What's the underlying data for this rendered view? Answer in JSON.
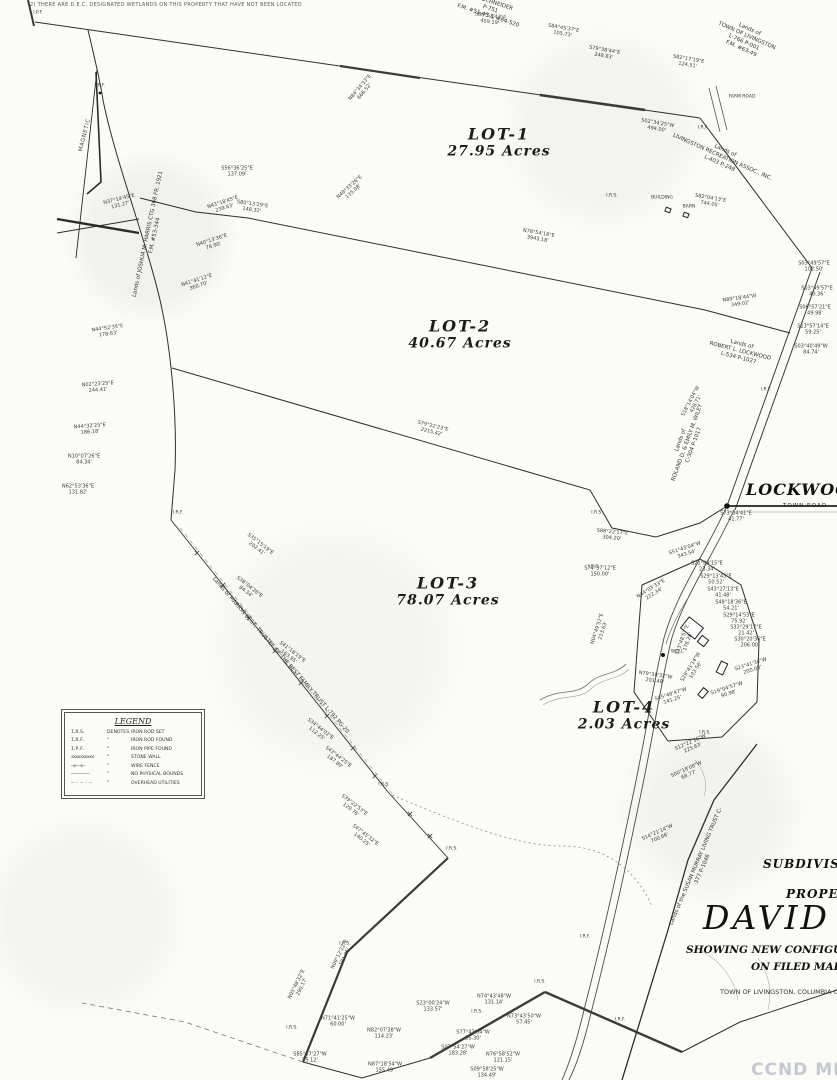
{
  "note": "2) THERE ARE D.E.C. DESIGNATED WETLANDS ON THIS PROPERTY THAT HAVE NOT BEEN LOCATED",
  "north_label": "MAGNETIC",
  "watermark": "CCND MLS",
  "roads": {
    "name": "LOCKWOOD R",
    "sub": "TOWN ROAD"
  },
  "title_block": {
    "line1": "SUBDIVISION",
    "line2": "PROPERTY",
    "name": "DAVID B",
    "line3": "SHOWING NEW CONFIGURAT",
    "line4": "ON FILED MAP #",
    "line5": "TOWN OF LIVINGSTON, COLUMBIA C"
  },
  "legend": {
    "title": "LEGEND",
    "rows": [
      {
        "sym": "I.R.S.",
        "mid": "DENOTES",
        "desc": "IRON ROD SET"
      },
      {
        "sym": "I.R.F.",
        "mid": "\"",
        "desc": "IRON ROD FOUND"
      },
      {
        "sym": "I.P.F.",
        "mid": "\"",
        "desc": "IRON PIPE FOUND"
      },
      {
        "sym": "xxxxxxxxxx",
        "mid": "\"",
        "desc": "STONE WALL"
      },
      {
        "sym": "—x——x—",
        "mid": "\"",
        "desc": "WIRE FENCE"
      },
      {
        "sym": "————————",
        "mid": "\"",
        "desc": "NO PHYSICAL BOUNDS"
      },
      {
        "sym": "— - — - —",
        "mid": "\"",
        "desc": "OVERHEAD UTILITIES"
      }
    ]
  },
  "lots": [
    {
      "name": "LOT-1",
      "acres": "27.95 Acres",
      "x": 499,
      "y": 142
    },
    {
      "name": "LOT-2",
      "acres": "40.67 Acres",
      "x": 460,
      "y": 334
    },
    {
      "name": "LOT-3",
      "acres": "78.07 Acres",
      "x": 448,
      "y": 591
    },
    {
      "name": "LOT-4",
      "acres": "2.03 Acres",
      "x": 624,
      "y": 715
    }
  ],
  "adjoiners": [
    {
      "text": "Y J. SCHNEIDER\nP-751\nF.M. #51-45 & #64-520",
      "x": 490,
      "y": 10,
      "r": 18,
      "size": 5.5
    },
    {
      "text": "Lands of\nTOWN OF LIVINGSTON\nL-766 P-001\nF.M. #63-49",
      "x": 745,
      "y": 40,
      "r": 24,
      "size": 5.5
    },
    {
      "text": "Lands of\nLIVINGSTON RECREATION ASSOC., INC.\nL-403 P-248",
      "x": 722,
      "y": 158,
      "r": 24,
      "size": 5.5
    },
    {
      "text": "Lands of\nROBERT L. LOCKWOOD\nL-534 P-1027",
      "x": 740,
      "y": 352,
      "r": 14,
      "size": 5.5
    },
    {
      "text": "Lands of\nROLAND D. & EMILY M. WILEY\nC-304 P-1017",
      "x": 688,
      "y": 443,
      "r": -70,
      "size": 5.5
    },
    {
      "text": "Lands of JOSHUA M. HARRIS CTG 368 FR. 1921\nF.M. #53-344",
      "x": 152,
      "y": 235,
      "r": -78,
      "size": 5.5
    },
    {
      "text": "Lands of MARION BEST, TRUSTEE OF THE BEST FAMILY TRUST  L-792 PG-20",
      "x": 280,
      "y": 656,
      "r": 49,
      "size": 5.5
    },
    {
      "text": "Lands of the SUSAN MURRAY LIVING TRUST  C-377 P-1046",
      "x": 700,
      "y": 868,
      "r": -67,
      "size": 5.5
    }
  ],
  "markers": [
    {
      "t": "I.P.F.",
      "x": 38,
      "y": 13
    },
    {
      "t": "I.R.F.",
      "x": 703,
      "y": 128
    },
    {
      "t": "FARM ROAD",
      "x": 742,
      "y": 97
    },
    {
      "t": "I.R.S.",
      "x": 612,
      "y": 196
    },
    {
      "t": "BUILDING",
      "x": 662,
      "y": 198
    },
    {
      "t": "BARN",
      "x": 689,
      "y": 207
    },
    {
      "t": "I.R.F.",
      "x": 766,
      "y": 390
    },
    {
      "t": "I.R.F.",
      "x": 100,
      "y": 86
    },
    {
      "t": "I.R.F.",
      "x": 178,
      "y": 513
    },
    {
      "t": "I.R.S.",
      "x": 597,
      "y": 513
    },
    {
      "t": "I.R.S.",
      "x": 594,
      "y": 567
    },
    {
      "t": "WELL",
      "x": 677,
      "y": 652
    },
    {
      "t": "I.R.S.",
      "x": 384,
      "y": 785
    },
    {
      "t": "I.R.S.",
      "x": 452,
      "y": 849
    },
    {
      "t": "I.R.S.",
      "x": 705,
      "y": 733
    },
    {
      "t": "I.R.F.",
      "x": 585,
      "y": 937
    },
    {
      "t": "I.R.S.",
      "x": 345,
      "y": 944
    },
    {
      "t": "I.R.S.",
      "x": 540,
      "y": 982
    },
    {
      "t": "I.R.S.",
      "x": 292,
      "y": 1028
    },
    {
      "t": "I.R.S.",
      "x": 477,
      "y": 1012
    },
    {
      "t": "I.R.F.",
      "x": 620,
      "y": 1020
    }
  ],
  "bearings": [
    {
      "t": "S80°53'43\"E",
      "d": "459.19'",
      "x": 490,
      "y": 20,
      "r": 8
    },
    {
      "t": "S84°45'37\"E",
      "d": "105.73'",
      "x": 563,
      "y": 32,
      "r": 10
    },
    {
      "t": "S79°38'44\"E",
      "d": "248.83'",
      "x": 604,
      "y": 54,
      "r": 10
    },
    {
      "t": "S82°17'19\"E",
      "d": "124.51'",
      "x": 688,
      "y": 63,
      "r": 10
    },
    {
      "t": "N84°34'33\"E",
      "d": "666.52'",
      "x": 363,
      "y": 90,
      "r": -50
    },
    {
      "t": "N49°33'26\"E",
      "d": "135.08'",
      "x": 352,
      "y": 190,
      "r": -42
    },
    {
      "t": "S56°36'25\"E",
      "d": "137.09'",
      "x": 237,
      "y": 172,
      "r": 0
    },
    {
      "t": "S80°13'29\"E",
      "d": "148.32'",
      "x": 252,
      "y": 208,
      "r": 8
    },
    {
      "t": "S02°34'25\"W",
      "d": "494.00'",
      "x": 657,
      "y": 127,
      "r": 10
    },
    {
      "t": "S82°04'13\"E",
      "d": "744.05'",
      "x": 710,
      "y": 202,
      "r": 10
    },
    {
      "t": "N89°18'44\"W",
      "d": "349.02'",
      "x": 740,
      "y": 302,
      "r": -8
    },
    {
      "t": "S03°49'57\"E",
      "d": "102.50'",
      "x": 814,
      "y": 267,
      "r": 0
    },
    {
      "t": "S03°49'57\"E",
      "d": "40.36'",
      "x": 817,
      "y": 292,
      "r": 0
    },
    {
      "t": "S06°57'21\"E",
      "d": "49.98'",
      "x": 815,
      "y": 311,
      "r": 0
    },
    {
      "t": "S13°57'14\"E",
      "d": "59.25'",
      "x": 813,
      "y": 330,
      "r": 0
    },
    {
      "t": "S03°40'49\"W",
      "d": "84.74'",
      "x": 811,
      "y": 350,
      "r": 0
    },
    {
      "t": "S18°14'04\"W",
      "d": "428.71'",
      "x": 694,
      "y": 403,
      "r": -62
    },
    {
      "t": "N78°54'18\"E",
      "d": "3943.18'",
      "x": 538,
      "y": 237,
      "r": 10
    },
    {
      "t": "S79°22'23\"E",
      "d": "2215.42'",
      "x": 432,
      "y": 430,
      "r": 14
    },
    {
      "t": "S88°22'17\"E",
      "d": "304.20'",
      "x": 612,
      "y": 536,
      "r": 6
    },
    {
      "t": "S73°34'41\"E",
      "d": "41.77'",
      "x": 736,
      "y": 517,
      "r": 0
    },
    {
      "t": "S51°43'04\"W",
      "d": "343.54'",
      "x": 686,
      "y": 552,
      "r": -18
    },
    {
      "t": "S74°37'12\"E",
      "d": "150.00'",
      "x": 600,
      "y": 572,
      "r": 0
    },
    {
      "t": "N37°14'45\"E",
      "d": "131.27'",
      "x": 120,
      "y": 203,
      "r": -14
    },
    {
      "t": "N43°18'45\"E",
      "d": "239.63'",
      "x": 224,
      "y": 206,
      "r": -18
    },
    {
      "t": "N40°13'36\"E",
      "d": "78.90'",
      "x": 213,
      "y": 244,
      "r": -18
    },
    {
      "t": "N41°41'12\"E",
      "d": "360.70'",
      "x": 198,
      "y": 284,
      "r": -18
    },
    {
      "t": "N44°52'35\"E",
      "d": "178.63'",
      "x": 108,
      "y": 332,
      "r": -8
    },
    {
      "t": "N02°23'25\"E",
      "d": "244.41'",
      "x": 98,
      "y": 388,
      "r": -4
    },
    {
      "t": "N44°32'25\"E",
      "d": "186.18'",
      "x": 90,
      "y": 430,
      "r": -4
    },
    {
      "t": "N10°07'26\"E",
      "d": "84.34'",
      "x": 84,
      "y": 460,
      "r": 0
    },
    {
      "t": "N62°53'36\"E",
      "d": "131.82'",
      "x": 78,
      "y": 490,
      "r": 0
    },
    {
      "t": "S35°15'19\"E",
      "d": "202.41'",
      "x": 258,
      "y": 547,
      "r": 38
    },
    {
      "t": "S38°04'26\"E",
      "d": "84.34'",
      "x": 247,
      "y": 590,
      "r": 38
    },
    {
      "t": "S41°18'19\"E",
      "d": "163.95'",
      "x": 290,
      "y": 655,
      "r": 38
    },
    {
      "t": "S34°44'02\"E",
      "d": "112.25'",
      "x": 318,
      "y": 732,
      "r": 38
    },
    {
      "t": "S43°44'25\"E",
      "d": "187.89'",
      "x": 336,
      "y": 760,
      "r": 38
    },
    {
      "t": "S39°22'53\"E",
      "d": "129.76'",
      "x": 352,
      "y": 808,
      "r": 38
    },
    {
      "t": "S47°45'32\"E",
      "d": "140.25'",
      "x": 363,
      "y": 838,
      "r": 38
    },
    {
      "t": "N09°12'22\"E",
      "d": "181.05'",
      "x": 343,
      "y": 956,
      "r": -64
    },
    {
      "t": "N05°48'32\"E",
      "d": "290.17'",
      "x": 300,
      "y": 986,
      "r": -64
    },
    {
      "t": "N71°41'25\"W",
      "d": "60.00'",
      "x": 338,
      "y": 1022,
      "r": 0
    },
    {
      "t": "N82°07'38\"W",
      "d": "114.23'",
      "x": 384,
      "y": 1034,
      "r": 0
    },
    {
      "t": "S23°00'24\"W",
      "d": "133.57'",
      "x": 433,
      "y": 1007,
      "r": 0
    },
    {
      "t": "N74°43'48\"W",
      "d": "131.14'",
      "x": 494,
      "y": 1000,
      "r": 0
    },
    {
      "t": "N73°43'50\"W",
      "d": "57.45'",
      "x": 524,
      "y": 1020,
      "r": 0
    },
    {
      "t": "S77°43'54\"W",
      "d": "55.30'",
      "x": 473,
      "y": 1036,
      "r": 0
    },
    {
      "t": "S07°54'27\"W",
      "d": "183.28'",
      "x": 458,
      "y": 1051,
      "r": 0
    },
    {
      "t": "N76°58'52\"W",
      "d": "121.15'",
      "x": 503,
      "y": 1058,
      "r": 0
    },
    {
      "t": "N87°18'54\"W",
      "d": "155.49'",
      "x": 385,
      "y": 1068,
      "r": 0
    },
    {
      "t": "S85°57'27\"W",
      "d": "75.12'",
      "x": 310,
      "y": 1058,
      "r": 0
    },
    {
      "t": "S09°58'25\"W",
      "d": "134.49'",
      "x": 487,
      "y": 1073,
      "r": 0
    },
    {
      "t": "S12°22'36\"W",
      "d": "225.63'",
      "x": 692,
      "y": 746,
      "r": -24
    },
    {
      "t": "S00°18'08\"W",
      "d": "68.77'",
      "x": 688,
      "y": 773,
      "r": -24
    },
    {
      "t": "S14°21'14\"W",
      "d": "700.66'",
      "x": 659,
      "y": 836,
      "r": -24
    },
    {
      "t": "S45°48'47\"W",
      "d": "141.25'",
      "x": 672,
      "y": 698,
      "r": -18
    },
    {
      "t": "S19°04'57\"W",
      "d": "90.98'",
      "x": 728,
      "y": 692,
      "r": -18
    },
    {
      "t": "S23°41'34\"W",
      "d": "200.00'",
      "x": 752,
      "y": 668,
      "r": -18
    },
    {
      "t": "N04°49'52\"E",
      "d": "213.63'",
      "x": 601,
      "y": 630,
      "r": -72
    },
    {
      "t": "N44°03'33\"E",
      "d": "222.34'",
      "x": 653,
      "y": 592,
      "r": -32
    },
    {
      "t": "S21°09'15\"E",
      "d": "23.34'",
      "x": 707,
      "y": 567,
      "r": 0
    },
    {
      "t": "S29°13'43\"E",
      "d": "50.52'",
      "x": 716,
      "y": 580,
      "r": 0
    },
    {
      "t": "S43°27'13\"E",
      "d": "41.48'",
      "x": 723,
      "y": 593,
      "r": 0
    },
    {
      "t": "S48°18'36\"E",
      "d": "54.21'",
      "x": 731,
      "y": 606,
      "r": 0
    },
    {
      "t": "S29°14'53\"E",
      "d": "75.92'",
      "x": 739,
      "y": 619,
      "r": 0
    },
    {
      "t": "S33°29'17\"E",
      "d": "21.42'",
      "x": 746,
      "y": 631,
      "r": 0
    },
    {
      "t": "S30°20'36\"E",
      "d": "206.00'",
      "x": 750,
      "y": 643,
      "r": 0
    },
    {
      "t": "S13°48'57\"E",
      "d": "178.26'",
      "x": 686,
      "y": 641,
      "r": -70
    },
    {
      "t": "S29°41'14\"W",
      "d": "103.56'",
      "x": 694,
      "y": 669,
      "r": -58
    },
    {
      "t": "N79°30'32\"W",
      "d": "201.48'",
      "x": 655,
      "y": 679,
      "r": 8
    }
  ]
}
